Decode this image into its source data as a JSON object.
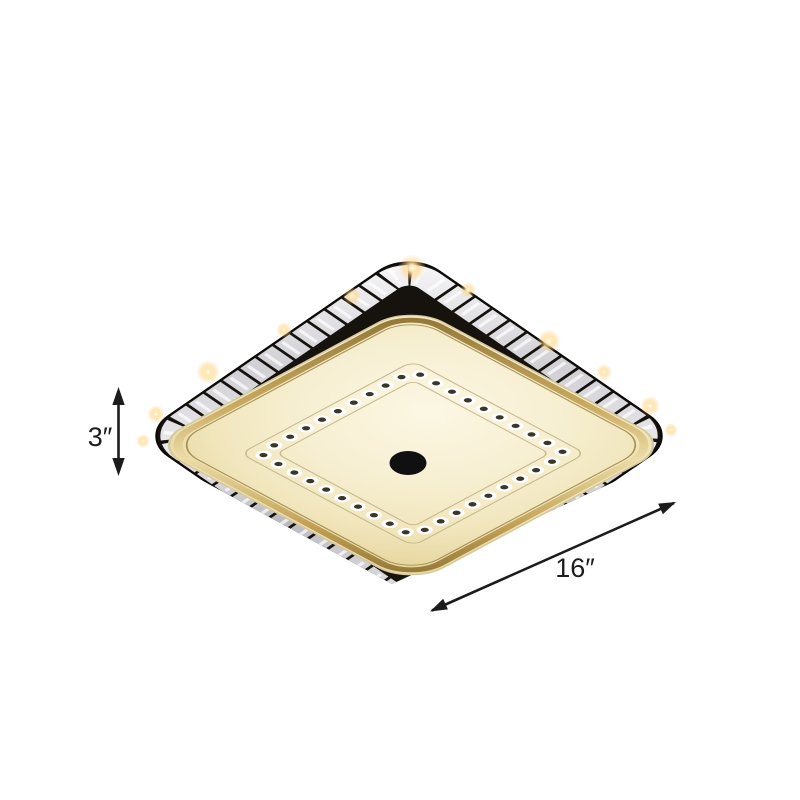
{
  "illustration": {
    "type": "product-dimension-diagram",
    "background": "#ffffff"
  },
  "dimensions": {
    "height_label": "3″",
    "width_label": "16″"
  },
  "icons": {
    "height_arrow": "double-headed-vertical-arrow-icon",
    "width_arrow": "double-headed-diagonal-arrow-icon",
    "sparkles": "sparkle-glint-icon"
  },
  "colors": {
    "background": "#ffffff",
    "annotation": "#1c1c1c",
    "lamp_face_cream": "#f6eecd",
    "lamp_rim_gold": "#c8a95e",
    "crystal_band_frame": "#16120e",
    "crystal_silver": "#e8e8ec",
    "crystal_dot_dark": "#3c352a",
    "glint_warm": "#ffd27e",
    "center_hole": "#101010"
  }
}
